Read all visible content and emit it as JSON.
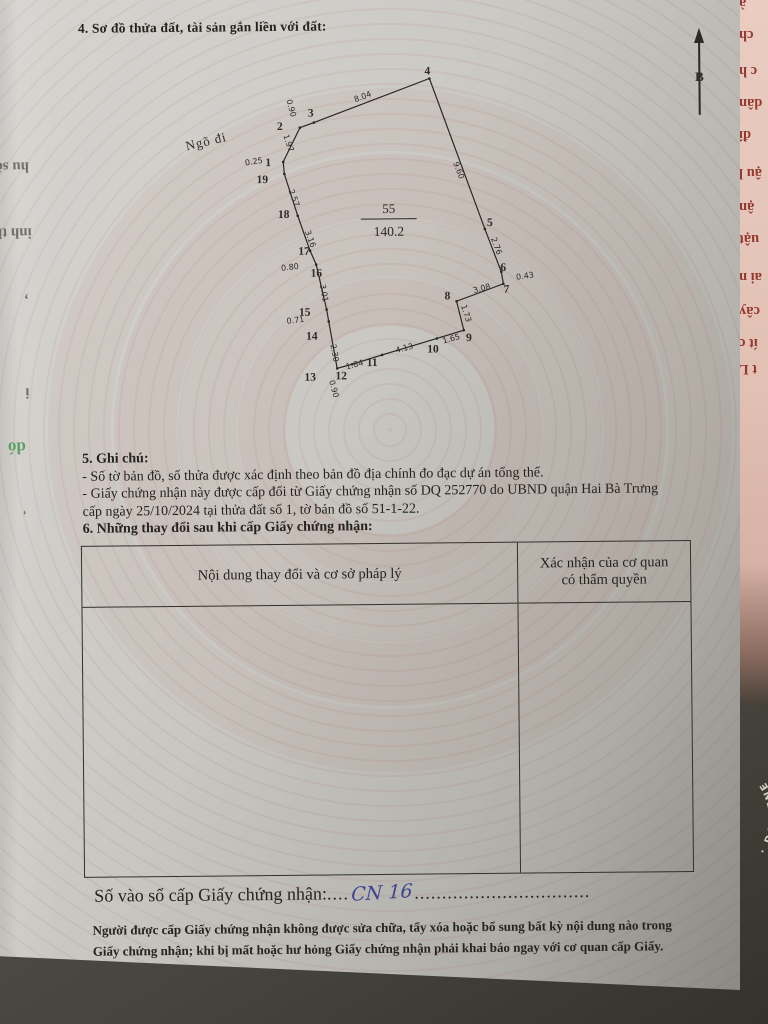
{
  "document": {
    "section4_title": "4. Sơ đồ thửa đất, tài sản gắn liền với đất:",
    "section5": {
      "title": "5. Ghi chú:",
      "note1": "- Số tờ bản đồ, số thửa được xác định theo bản đồ địa chính đo đạc dự án tổng thể.",
      "note2": "- Giấy chứng nhận này được cấp đổi từ Giấy chứng nhận số DQ 252770 do UBND quận Hai Bà Trưng cấp ngày 25/10/2024 tại thửa đất số 1, tờ bản đồ số 51-1-22."
    },
    "section6": {
      "title": "6. Những thay đổi sau khi cấp Giấy chứng nhận:",
      "table": {
        "col1_header": "Nội dung thay đổi và cơ sở pháp lý",
        "col2_header_line1": "Xác nhận của cơ quan",
        "col2_header_line2": "có thẩm quyền"
      }
    },
    "registry": {
      "label": "Số vào sổ cấp Giấy chứng nhận:",
      "dots_before": "....",
      "handwritten_value": "CN 16",
      "dots_after": "................................"
    },
    "footer_line1": "Người được cấp Giấy chứng nhận không được sửa chữa, tẩy xóa hoặc bổ sung bất kỳ nội dung nào trong",
    "footer_line2": "Giấy chứng nhận; khi bị mất hoặc hư hỏng Giấy chứng nhận phải khai báo ngay với cơ quan cấp Giấy."
  },
  "diagram": {
    "road_label": "Ngõ đi",
    "north_symbol": "B",
    "parcel_number": "55",
    "parcel_area": "140.2",
    "vertices": [
      "1",
      "2",
      "3",
      "4",
      "5",
      "6",
      "7",
      "8",
      "9",
      "10",
      "11",
      "12",
      "13",
      "14",
      "15",
      "16",
      "17",
      "18",
      "19"
    ],
    "edge_lengths": [
      "0.25",
      "1.97",
      "0.90",
      "8.04",
      "9.60",
      "2.76",
      "0.43",
      "3.08",
      "1.73",
      "1.65",
      "4.13",
      "1.84",
      "0.90",
      "2.30",
      "0.71",
      "3.01",
      "0.80",
      "3.16",
      "2.57"
    ]
  },
  "surroundings": {
    "right_page_fragments": [
      "à",
      "ch",
      "c h",
      "dân",
      "đi",
      "ậu l",
      "ận",
      "uật",
      "ai n",
      "cây",
      "ít c",
      "t L"
    ],
    "left_showthrough_fragments": [
      "hu số",
      "inh th",
      ",",
      "i",
      "dó",
      "'"
    ],
    "seal_arc_text": "· DA GENERA"
  },
  "colors": {
    "paper": "#c9c7c2",
    "ink": "#26231f",
    "handwriting_blue": "#3f4490",
    "fragment_red": "#93392f",
    "showthrough_green": "#5f9e66",
    "pink_page": "#e0bdb2"
  }
}
